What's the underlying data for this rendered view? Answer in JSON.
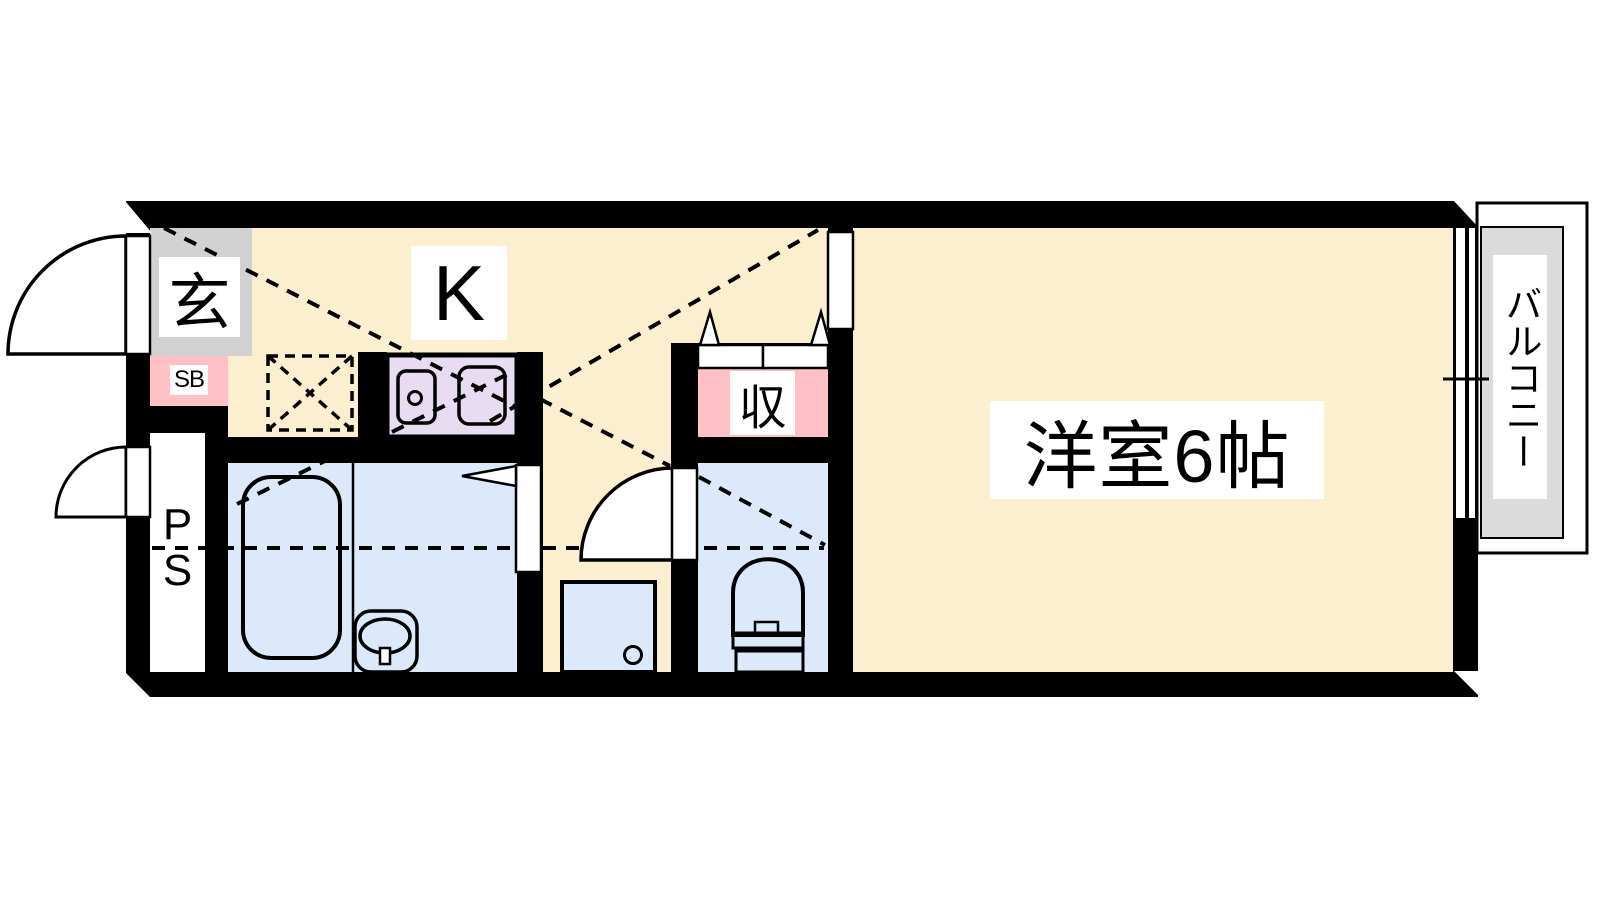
{
  "rooms": {
    "entrance": {
      "label": "玄"
    },
    "shoe_box": {
      "label": "SB"
    },
    "kitchen": {
      "label": "K"
    },
    "pipe_space": {
      "letters": [
        "P",
        "S"
      ]
    },
    "closet": {
      "label": "収"
    },
    "western_room": {
      "label": "洋室6帖"
    },
    "balcony": {
      "label": "バルコニー"
    }
  },
  "colors": {
    "wall": "#000000",
    "floor_cream": "#FCEFCF",
    "entrance_gray": "#D2D2D2",
    "accent_pink": "#FFC1C6",
    "wet_area_blue": "#DBE9FB",
    "counter_purple": "#E7DCF2",
    "balcony_gray": "#DBDBDB",
    "label_background": "#FFFFFF"
  }
}
